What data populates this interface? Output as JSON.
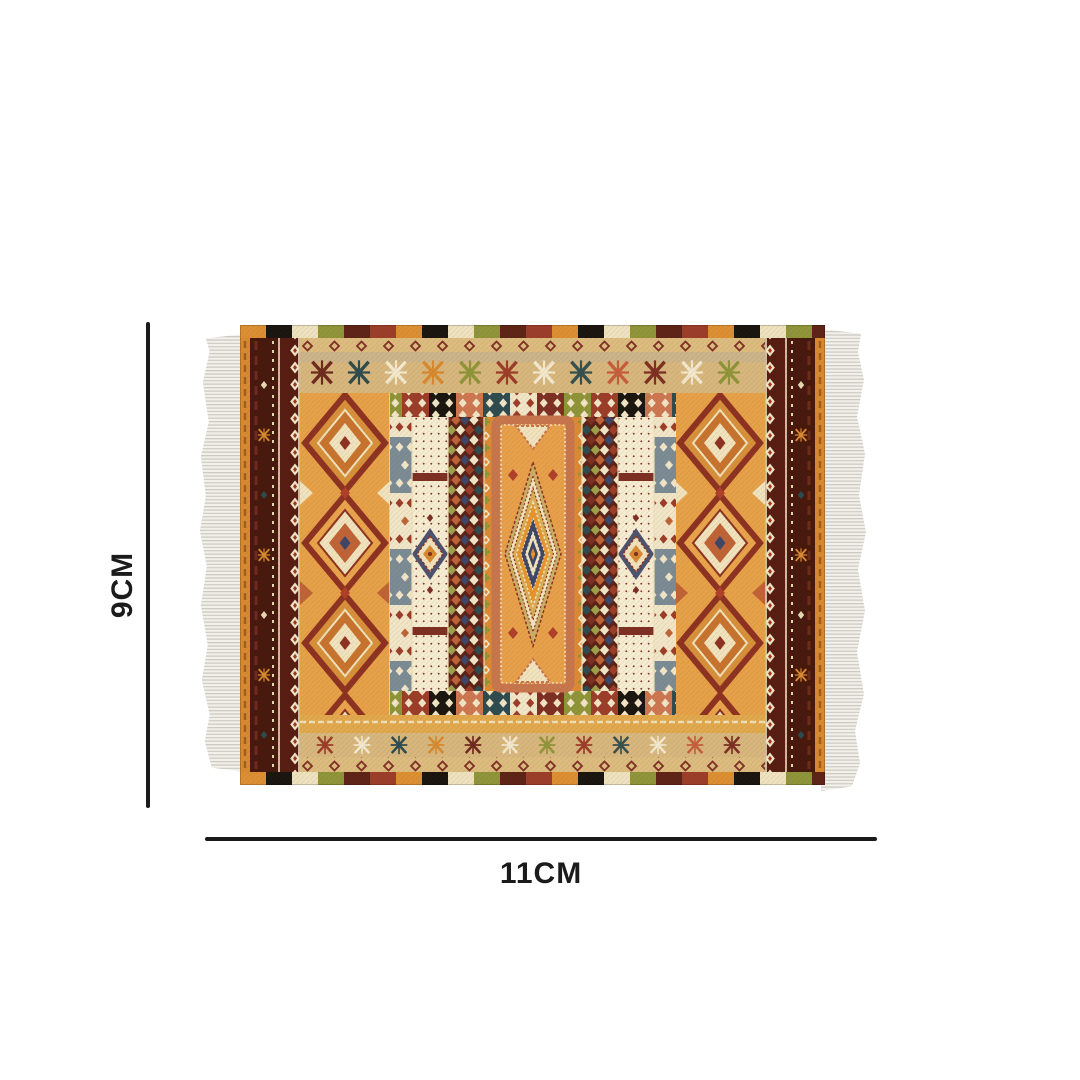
{
  "diagram": {
    "height_label": "9CM",
    "width_label": "11CM"
  },
  "rug": {
    "type": "kilim-pattern-rug",
    "fringe_sides": [
      "left",
      "right"
    ]
  },
  "palette": {
    "line": "#1b1b1b",
    "bg": "#ffffff",
    "fringe": "#f1f0ea",
    "fringe_strand": "#c7c5bc",
    "orange": "#E9A44C",
    "orange_deep": "#D88A30",
    "maroon": "#7E2F24",
    "dark_brown": "#47190E",
    "red": "#9C3D2A",
    "rust": "#C06438",
    "salmon": "#C8764E",
    "cream": "#F2E6C8",
    "tan": "#D8B77E",
    "olive": "#8F9539",
    "teal": "#2E4B50",
    "navy": "#3E4668",
    "gold": "#D8AE55",
    "black": "#1A150F"
  }
}
